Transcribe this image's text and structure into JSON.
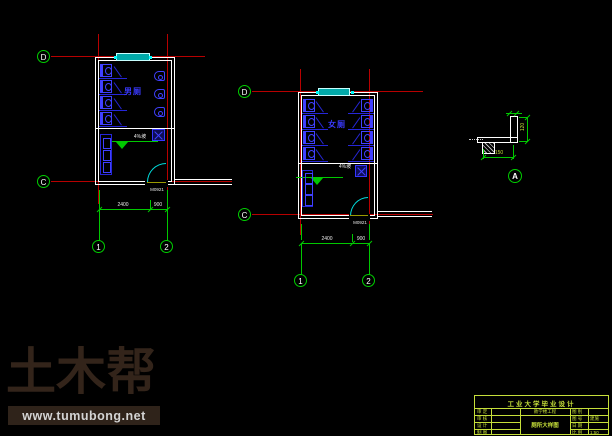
{
  "plan1": {
    "room_label": "男厕",
    "bubbles": {
      "d": "D",
      "c": "C",
      "n1": "1",
      "n2": "2"
    },
    "dims": {
      "main": "2400",
      "door": "900"
    },
    "door_tag": "M0921",
    "slope_note": "4%坡"
  },
  "plan2": {
    "room_label": "女厕",
    "bubbles": {
      "d": "D",
      "c": "C",
      "n1": "1",
      "n2": "2"
    },
    "dims": {
      "main": "2400",
      "door": "900"
    },
    "door_tag": "M0921",
    "slope_note": "4%坡"
  },
  "detail": {
    "bubble": "A",
    "dim_right": "120",
    "dim_bottom": "150"
  },
  "watermark": {
    "brand": "土木帮",
    "url": "www.tumubong.net"
  },
  "title_block": {
    "title": "工业大学毕业设计",
    "left_labels": [
      "审 定",
      "审 核",
      "设 计",
      "制 图"
    ],
    "project": "教学楼工程",
    "drawing_name": "厕所大样图",
    "right_labels": [
      "图 别",
      "图 号",
      "日 期",
      "比 例"
    ],
    "right_values": [
      "",
      "建施",
      "",
      "1:50"
    ]
  },
  "colors": {
    "grid_red": "#b80000",
    "dim_green": "#00c800",
    "fixture_blue": "#2626d8",
    "door_cyan": "#00dddd",
    "title_green": "#c6df3a",
    "watermark_brown": "#33241a"
  }
}
